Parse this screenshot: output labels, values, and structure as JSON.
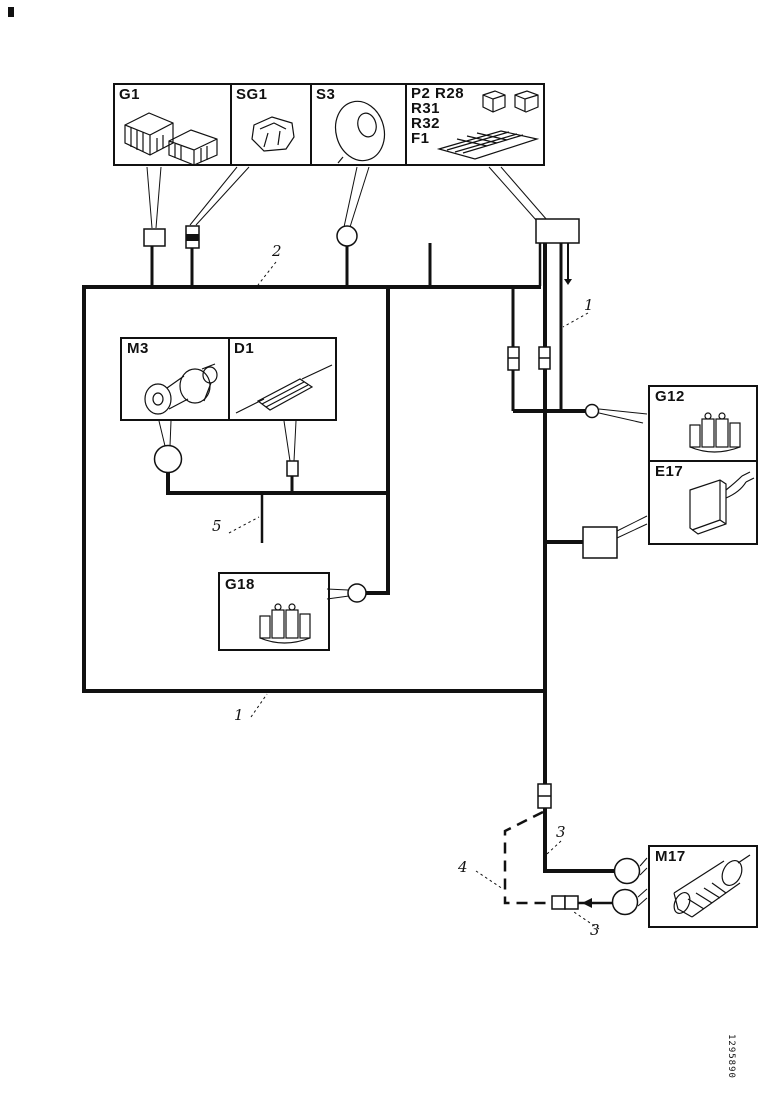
{
  "page": {
    "doc_number": "1295890"
  },
  "components": {
    "g1": {
      "label": "G1",
      "icon": "battery-units-icon"
    },
    "sg1": {
      "label": "SG1",
      "icon": "relay-module-icon"
    },
    "s3": {
      "label": "S3",
      "icon": "horn-icon"
    },
    "relay_fuse": {
      "row1": "P2 R28",
      "row2": "R31",
      "row3": "R32",
      "row4": "F1",
      "icon": "relays-fuse-panel-icon"
    },
    "m3": {
      "label": "M3",
      "icon": "motor-icon"
    },
    "d1": {
      "label": "D1",
      "icon": "diode-icon"
    },
    "g12": {
      "label": "G12",
      "icon": "connector-block-icon"
    },
    "e17": {
      "label": "E17",
      "icon": "flasher-unit-icon"
    },
    "g18": {
      "label": "G18",
      "icon": "connector-block-icon"
    },
    "m17": {
      "label": "M17",
      "icon": "pump-motor-icon"
    }
  },
  "wire_labels": {
    "top_harness": "2",
    "right_trunk": "1",
    "bottom_edge": "1",
    "upper_branch": "3",
    "lower_branch": "3",
    "dashed_wire": "4",
    "inner_stub": "5"
  }
}
